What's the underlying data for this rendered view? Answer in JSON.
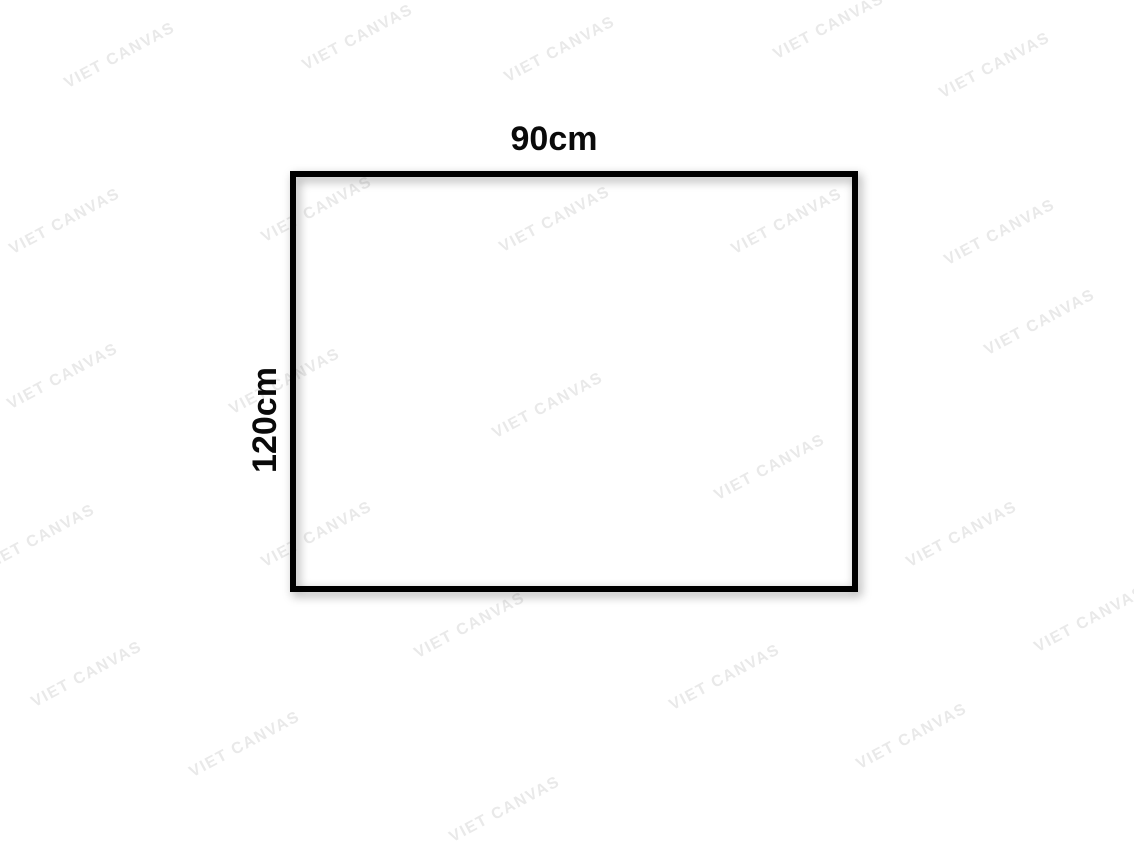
{
  "page": {
    "background_color": "#ffffff"
  },
  "diagram": {
    "type": "canvas-size-mockup",
    "width_label": "90cm",
    "height_label": "120cm",
    "frame_color": "#000000",
    "label_color": "#0a0a0a"
  },
  "watermark": {
    "text": "VIET CANVAS",
    "color": "#e9e9e9"
  }
}
